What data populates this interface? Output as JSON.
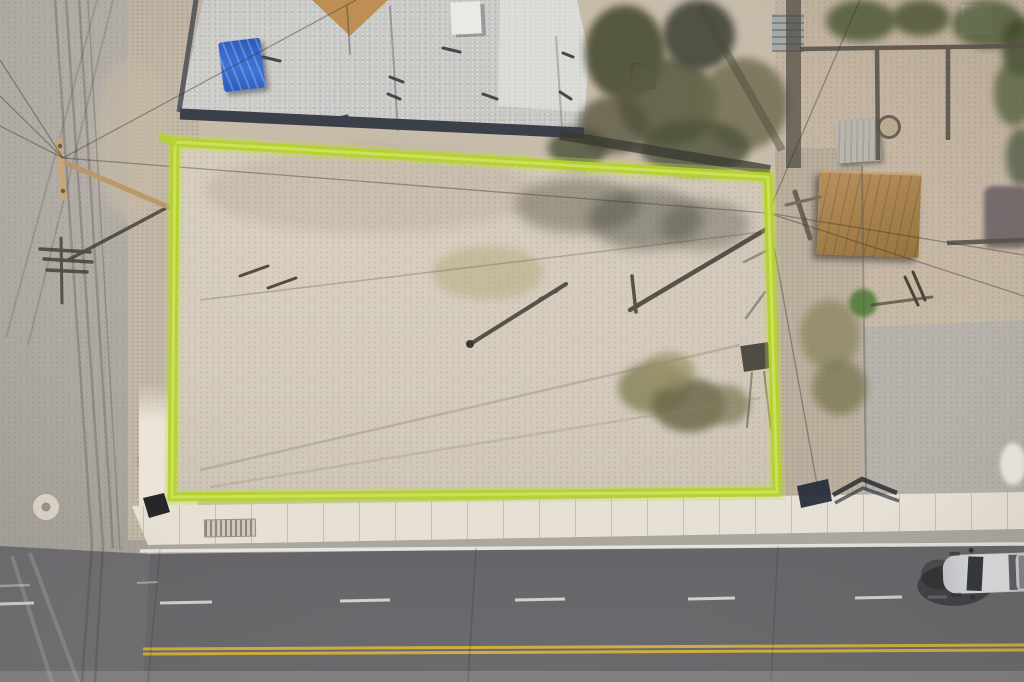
{
  "scene": {
    "type": "aerial-drone-photo",
    "description": "Top-down aerial drone photograph of a vacant dirt corner lot outlined with a bright chartreuse-green property boundary. A flat-roofed commercial building with a blue tarp sits at the top edge, a light concrete side street runs along the left, neighboring walled yards with a tan-roofed shed and trees lie to the right, and a dark asphalt road with white lane dashes, a white edge line and a double yellow centerline runs along the bottom, where a silver vehicle is driving near the lower-right corner.",
    "palette": {
      "boundary_green": "#b4d12f",
      "boundary_glow": "#c4de46",
      "lot_dirt": "#cdc4b6",
      "surround_dirt": "#c2b3a0",
      "side_street_concrete": "#aca7a1",
      "sidewalk": "#ebe5d9",
      "asphalt_road": "#5f5e61",
      "lane_white": "#e9e9e4",
      "lane_yellow": "#d8b23e",
      "building_roof": "#c7c7c4",
      "roof_shadow": "#3b3f49",
      "tarp_blue": "#2f63c6",
      "roof_pyramid_tan": "#b3854b",
      "shed_tan_roof": "#a7804e",
      "shed_gray": "#b2b0a9",
      "vegetation_dark": "#4e5038",
      "dry_grass": "#8a8560",
      "vehicle_silver": "#cfd1d4",
      "pole_wood_tan": "#b9986a"
    },
    "objects": [
      "vacant-lot",
      "property-boundary-outline",
      "commercial-building-roof",
      "blue-tarp",
      "rooftop-hvac-unit",
      "roof-pyramid-skylight",
      "side-street",
      "utility-pole",
      "utility-pole-shadow",
      "power-lines",
      "tree-canopy",
      "tree-shadow",
      "dry-grass-cluster",
      "neighbor-shed-tan-roof",
      "neighbor-shed-gray",
      "stone-wall",
      "gravel-alley",
      "concrete-pad",
      "sidewalk",
      "curb-ramp",
      "storm-drain-grate",
      "manhole-cover",
      "corner-sign",
      "chevron-sign-shadow",
      "main-road",
      "white-edge-line",
      "white-lane-dashes",
      "double-yellow-centerline",
      "silver-vehicle",
      "vehicle-shadow"
    ]
  }
}
